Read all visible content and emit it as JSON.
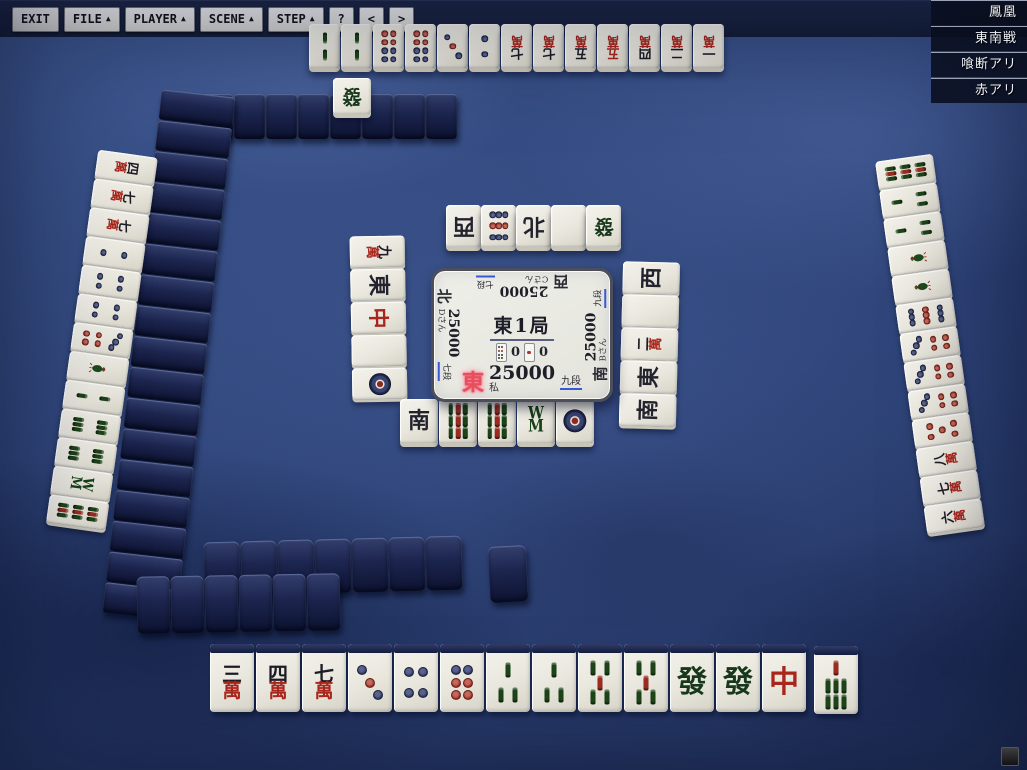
{
  "colors": {
    "accent_red": "#e5505e",
    "tile_back_navy": "#1b2347",
    "underline_blue": "#3a57d6"
  },
  "rules_panel": [
    "鳳凰",
    "東南戦",
    "喰断アリ",
    "赤アリ"
  ],
  "center_panel": {
    "round": "東1局",
    "counters": [
      {
        "icon": "hundred-point-stick",
        "value": "0"
      },
      {
        "icon": "thousand-point-stick",
        "value": "0"
      }
    ],
    "players": [
      {
        "pos": "self",
        "wind": "東",
        "score": "25000",
        "rank": "九段",
        "name": "私",
        "active": true
      },
      {
        "pos": "right",
        "wind": "南",
        "score": "25000",
        "rank": "九段",
        "name": "Bさん",
        "active": false
      },
      {
        "pos": "top",
        "wind": "西",
        "score": "25000",
        "rank": "七段",
        "name": "Cさん",
        "active": false
      },
      {
        "pos": "left",
        "wind": "北",
        "score": "25000",
        "rank": "七段",
        "name": "Dさん",
        "active": false
      }
    ]
  },
  "hands": {
    "self": {
      "tiles": [
        "3m",
        "4m",
        "7m",
        "3p",
        "4p",
        "6p",
        "3s",
        "3s",
        "5s",
        "5s",
        "F",
        "F",
        "C"
      ],
      "drawn": "7s"
    },
    "top": [
      "2s",
      "2s",
      "8p",
      "8p",
      "3p",
      "2p",
      "7m",
      "7m",
      "5m",
      "5mR",
      "4m",
      "2m",
      "1m"
    ],
    "left": [
      "4m",
      "7m",
      "7m",
      "2p",
      "4p",
      "4p",
      "7p",
      "1s",
      "2s",
      "6s",
      "6s",
      "8s",
      "9s"
    ],
    "right": [
      "9s",
      "3s",
      "3s",
      "1s",
      "1s",
      "9p",
      "7p",
      "7p",
      "7p",
      "5pR",
      "8m",
      "7m",
      "6m"
    ]
  },
  "discards": {
    "self": [
      "S",
      "9s",
      "9s",
      "8s",
      "1p"
    ],
    "top": [
      "W",
      "9p",
      "N",
      "H",
      "F"
    ],
    "left": [
      "9m",
      "E",
      "C",
      "H",
      "1p"
    ],
    "right": [
      "W",
      "H",
      "2m",
      "E",
      "S"
    ]
  },
  "dora_indicator": "F",
  "walls": {
    "top": 8,
    "left": 17,
    "bottom_mid": 7,
    "bottom_lone": 1,
    "bottom_front": 6
  },
  "tile_labels": {
    "1m": "一",
    "2m": "二",
    "3m": "三",
    "4m": "四",
    "5m": "五",
    "6m": "六",
    "7m": "七",
    "8m": "八",
    "9m": "九",
    "man": "萬",
    "E": "東",
    "S": "南",
    "W": "西",
    "N": "北",
    "C": "中",
    "F": "發",
    "H": ""
  },
  "toolbar": [
    {
      "label": "EXIT",
      "arrow": ""
    },
    {
      "label": "FILE",
      "arrow": "▲"
    },
    {
      "label": "PLAYER",
      "arrow": "▲"
    },
    {
      "label": "SCENE",
      "arrow": "▲"
    },
    {
      "label": "STEP",
      "arrow": "▲"
    },
    {
      "label": "?",
      "arrow": ""
    },
    {
      "label": "<",
      "arrow": ""
    },
    {
      "label": ">",
      "arrow": ""
    }
  ]
}
